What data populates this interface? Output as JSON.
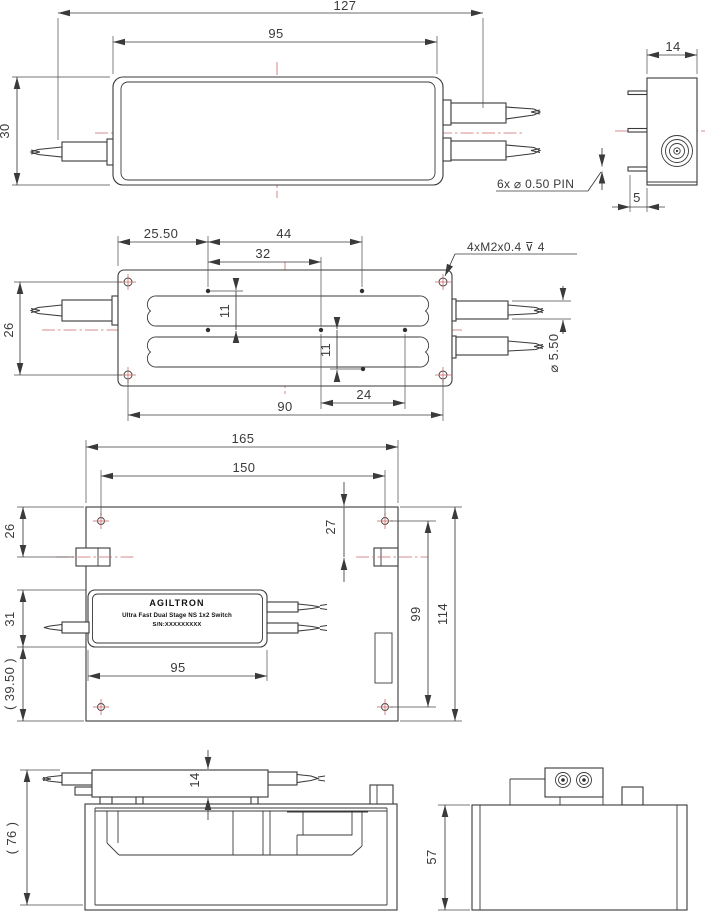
{
  "colors": {
    "object_line": "#3a3a3a",
    "centerline_red": "#c96a6a",
    "background": "#ffffff"
  },
  "views": {
    "package_top": {
      "dim_overall_length": "127",
      "dim_body_length": "95",
      "dim_height": "30"
    },
    "package_side": {
      "dim_width": "14",
      "dim_pin_inset": "5",
      "note_pins": "6x ⌀ 0.50 PIN"
    },
    "bracket_top": {
      "dim_left_offset": "25.50",
      "dim_pin_span_long": "44",
      "dim_pin_span_mid": "32",
      "dim_hole_spacing_vertical": "26",
      "dim_pin_pitch_upper": "11",
      "dim_pin_pitch_lower": "11",
      "dim_hole_spacing_horizontal": "90",
      "dim_pin_span_short": "24",
      "note_thread": "4xM2x0.4 ⊽ 4",
      "dim_ferrule_diameter": "⌀ 5.50"
    },
    "base_top": {
      "dim_overall_width": "165",
      "dim_hole_span": "150",
      "dim_tab_offset_left": "26",
      "dim_tab_offset_right": "27",
      "dim_device_offset": "31",
      "dim_ref_offset": "( 39.50 )",
      "dim_device_length": "95",
      "dim_hole_span_vertical": "99",
      "dim_overall_height": "114"
    },
    "device_label": {
      "brand": "AGILTRON",
      "product": "Ultra Fast Dual Stage NS 1x2 Switch",
      "serial": "S/N:XXXXXXXXX"
    },
    "assembly_side": {
      "dim_ref_height": "( 76 )",
      "dim_device_height": "14"
    },
    "assembly_end": {
      "dim_height": "57"
    }
  }
}
